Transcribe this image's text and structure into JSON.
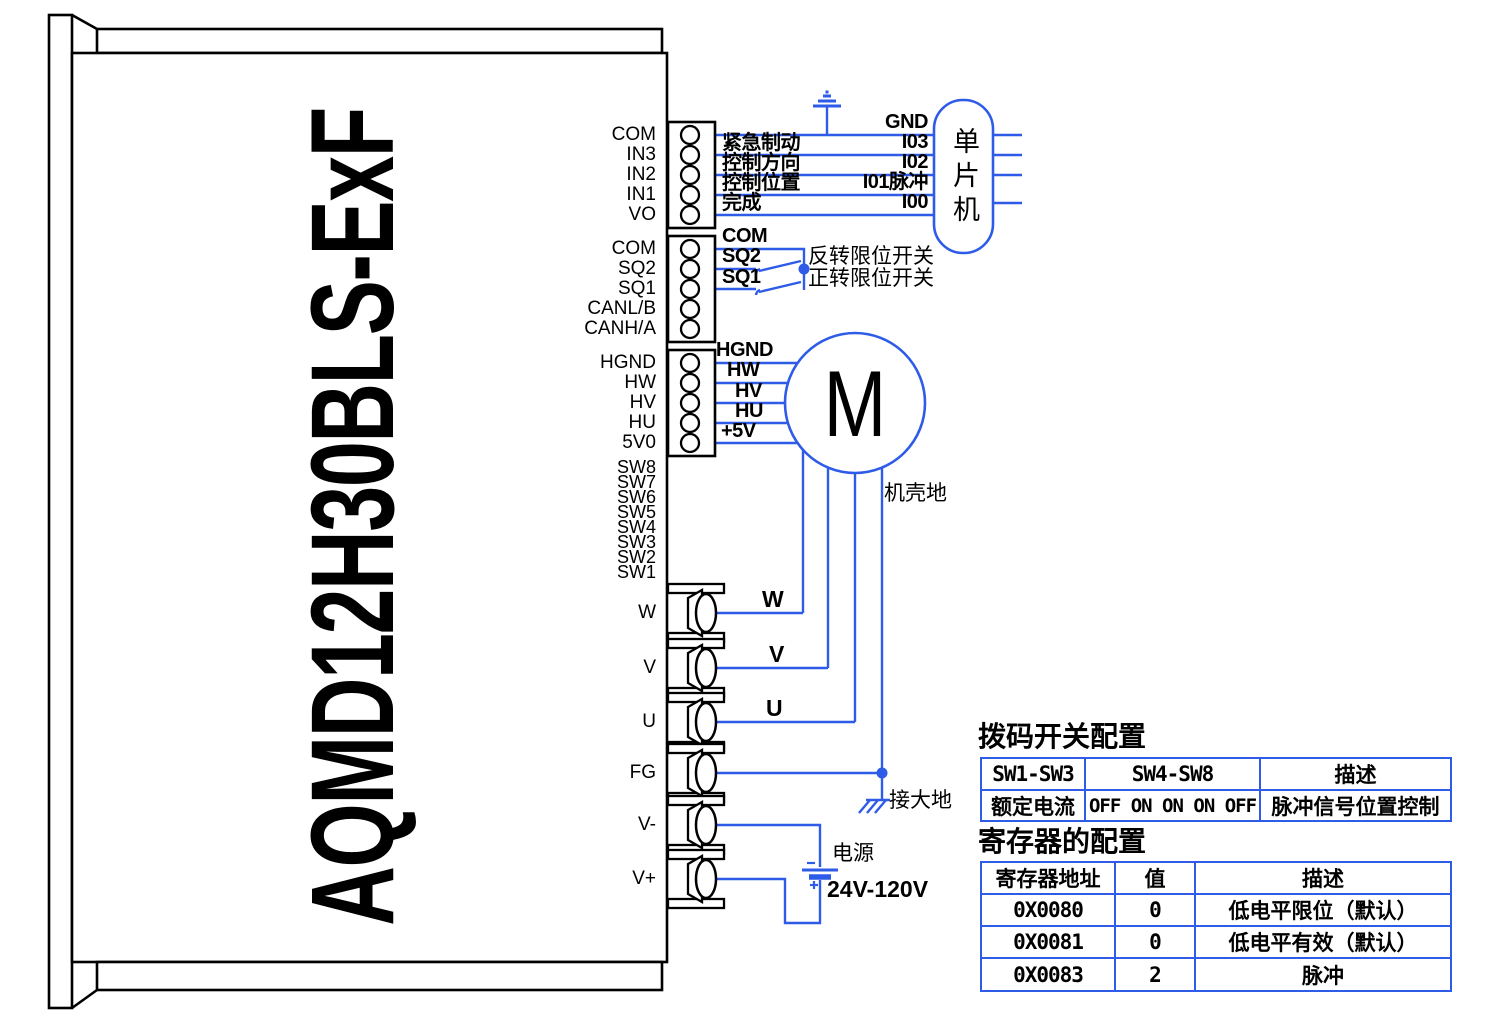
{
  "device": {
    "model": "AQMD12H30BLS-ExF"
  },
  "colors": {
    "wire_blue": "#2e5be8",
    "line_black": "#000000"
  },
  "terminal_blocks": [
    {
      "terminals": [
        "COM",
        "IN3",
        "IN2",
        "IN1",
        "VO"
      ]
    },
    {
      "terminals": [
        "COM",
        "SQ2",
        "SQ1",
        "CANL/B",
        "CANH/A"
      ]
    },
    {
      "terminals": [
        "HGND",
        "HW",
        "HV",
        "HU",
        "5V0"
      ]
    }
  ],
  "dip_switches": [
    "SW8",
    "SW7",
    "SW6",
    "SW5",
    "SW4",
    "SW3",
    "SW2",
    "SW1"
  ],
  "power_terminals": [
    "W",
    "V",
    "U",
    "FG",
    "V-",
    "V+"
  ],
  "mcu": {
    "label": "单片机"
  },
  "io": {
    "gnd": "GND",
    "i03": "I03",
    "i02": "I02",
    "i01": "I01脉冲",
    "i00": "I00",
    "estop": "紧急制动",
    "direction": "控制方向",
    "position": "控制位置",
    "done": "完成"
  },
  "limit": {
    "com": "COM",
    "sq2": "SQ2",
    "sq1": "SQ1",
    "reverse": "反转限位开关",
    "forward": "正转限位开关"
  },
  "motor": {
    "symbol": "M",
    "hall": [
      "HGND",
      "HW",
      "HV",
      "HU",
      "+5V"
    ],
    "phases": [
      "W",
      "V",
      "U"
    ],
    "chassis": "机壳地"
  },
  "earth_label": "接大地",
  "power_supply": {
    "label": "电源",
    "range": "24V-120V"
  },
  "dip_table": {
    "title": "拨码开关配置",
    "headers": [
      "SW1-SW3",
      "SW4-SW8",
      "描述"
    ],
    "rows": [
      [
        "额定电流",
        "OFF ON ON ON OFF",
        "脉冲信号位置控制"
      ]
    ]
  },
  "reg_table": {
    "title": "寄存器的配置",
    "headers": [
      "寄存器地址",
      "值",
      "描述"
    ],
    "rows": [
      [
        "0X0080",
        "0",
        "低电平限位（默认）"
      ],
      [
        "0X0081",
        "0",
        "低电平有效（默认）"
      ],
      [
        "0X0083",
        "2",
        "脉冲"
      ]
    ]
  }
}
